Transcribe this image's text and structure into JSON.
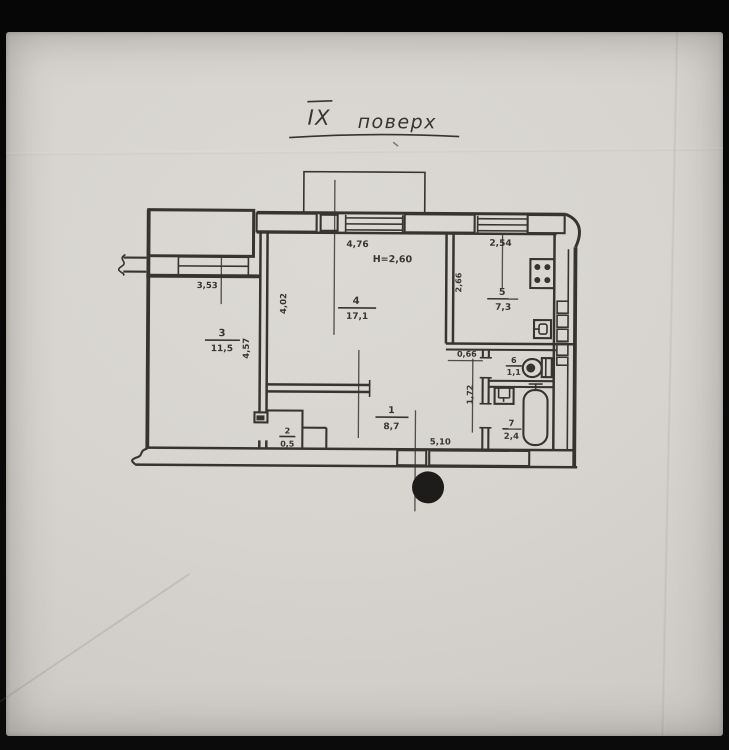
{
  "photo": {
    "paper_color": "#d7d4cf",
    "ink_color": "#2a2722",
    "background_color": "#0a0a0a"
  },
  "plan": {
    "title": {
      "roman": "ІХ",
      "word": "поверх"
    },
    "height_note": "Н=2,60",
    "rooms": {
      "hall": {
        "number": "1",
        "area": "8,7"
      },
      "closet": {
        "number": "2",
        "area": "0,5"
      },
      "room3": {
        "number": "3",
        "area": "11,5"
      },
      "room4": {
        "number": "4",
        "area": "17,1"
      },
      "kitchen": {
        "number": "5",
        "area": "7,3"
      },
      "wc": {
        "number": "6",
        "area": "1,1"
      },
      "bath": {
        "number": "7",
        "area": "2,4"
      }
    },
    "dims": {
      "win_room4": "4,76",
      "win_kitchen": "2,54",
      "win_room3": "3,53",
      "room3_depth": "4,57",
      "room4_left": "4,02",
      "kitchen_left": "2,66",
      "niche": "0,66",
      "bath_left": "1,72",
      "hall_width": "5,10"
    }
  }
}
